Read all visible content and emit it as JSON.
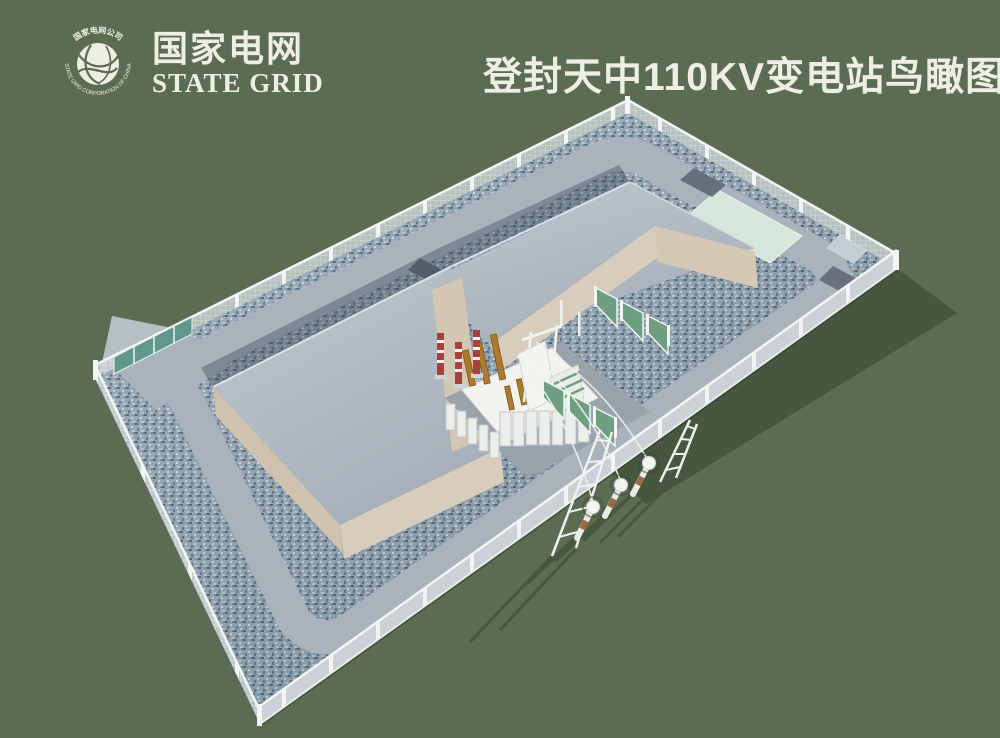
{
  "header": {
    "logo": {
      "name_cn": "国家电网",
      "name_en": "STATE GRID",
      "ring_text_cn": "国家电网公司",
      "ring_text_en": "STATE GRID CORPORATION OF CHINA"
    },
    "title": "登封天中110KV变电站鸟瞰图"
  },
  "scene": {
    "type": "3d-aerial-rendering",
    "subject": "110KV substation compound bird's-eye view",
    "parts": [
      {
        "name": "perimeter-fence",
        "color": "#f1f3f0"
      },
      {
        "name": "gravel-yard",
        "color": "#94a6b3"
      },
      {
        "name": "ring-road",
        "color": "#aab3bb"
      },
      {
        "name": "main-building",
        "roof_color": "#b2bac3",
        "wall_color": "#d8cdbc"
      },
      {
        "name": "main-transformer",
        "color": "#f2f3ef"
      },
      {
        "name": "transformer-bushings",
        "color": "#b07a2e"
      },
      {
        "name": "surge-arresters",
        "color": "#ac3f3a"
      },
      {
        "name": "safety-fence-panels",
        "color": "#6f9f81"
      },
      {
        "name": "entrance-gate",
        "color": "#5f998c"
      },
      {
        "name": "gate-apron",
        "color": "#b7bfc5"
      },
      {
        "name": "lawn-strip",
        "color": "#d5e7dc"
      },
      {
        "name": "equipment-pads",
        "color": "#68727e"
      },
      {
        "name": "terminal-poles",
        "color": "#e9ece8"
      },
      {
        "name": "guy-frames",
        "color": "#eef1ee"
      },
      {
        "name": "overhead-lines",
        "color": "#edf1ec"
      },
      {
        "name": "cast-shadow",
        "color": "#46563f"
      }
    ]
  },
  "colors": {
    "background": "#5c6c53",
    "title_text": "#edefe3",
    "gravel": "#94a6b3",
    "road": "#aab3bb",
    "roof": "#b2bac3",
    "wall_tan": "#d8cdbc",
    "fence_white": "#f1f3f0",
    "gate_teal": "#5f998c",
    "lawn_patch": "#d5e7dc",
    "panel_green": "#6f9f81",
    "transformer_white": "#f2f3ef",
    "bushing_orange": "#b07a2e",
    "arrester_red": "#ac3f3a",
    "shadow_green": "#46563f"
  }
}
